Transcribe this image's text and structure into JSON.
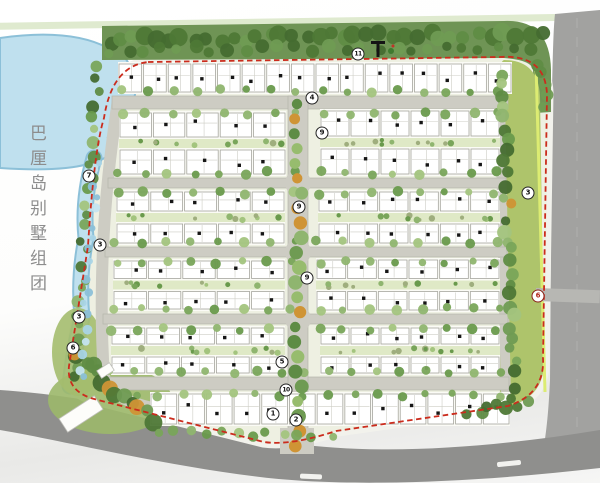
{
  "title": {
    "text": "巴厘岛别墅组团"
  },
  "colors": {
    "pale_strip": "#d9e6c7",
    "site_base": "#eef0e2",
    "water_fill": "#bfe0ee",
    "water_edge": "#8cc0d8",
    "tree_band": "#6f9455",
    "buffer_fill": "#aec46b",
    "buffer_line": "#dcec72",
    "road_fill": "#cdccc3",
    "road_edge": "#b6b5ac",
    "outer_road": "#a2a2a0",
    "bottom_road": "#8f8f8d",
    "boundary_red": "#cb2c1d",
    "house_fill": "#ffffff",
    "house_stroke": "#a6a69e",
    "house_inner": "#cdcdc5",
    "house_dot": "#161616",
    "garden": "#dfe9c6",
    "hedge": "#9fae7e",
    "tree_dark": [
      "#4e7836",
      "#5f8c44",
      "#446b30",
      "#6f9b53"
    ],
    "tree_street": [
      "#79a55a",
      "#8fb56f",
      "#699a4c",
      "#a3c47e"
    ],
    "tree_median": [
      "#6f9b53",
      "#8fb56f",
      "#5e8c45",
      "#97bc6e"
    ],
    "tree_orange": "#cf9435",
    "water_scallop": [
      "#a9d4e6",
      "#8cc0d8",
      "#c4e4f0"
    ],
    "white_dash": "#f2f2ef",
    "building_fill": "#fdfdfa",
    "gate_black": "#141414",
    "gate_green": "#3f7a2f",
    "gate_red": "#c23327",
    "title_color": "#8d8d8d"
  },
  "markers": [
    {
      "label": "7",
      "x": 89,
      "y": 176
    },
    {
      "label": "3",
      "x": 100,
      "y": 245
    },
    {
      "label": "3",
      "x": 79,
      "y": 317
    },
    {
      "label": "6",
      "x": 73,
      "y": 348
    },
    {
      "label": "11",
      "x": 358,
      "y": 54
    },
    {
      "label": "4",
      "x": 312,
      "y": 98
    },
    {
      "label": "9",
      "x": 322,
      "y": 133
    },
    {
      "label": "9",
      "x": 299,
      "y": 207
    },
    {
      "label": "9",
      "x": 307,
      "y": 278
    },
    {
      "label": "5",
      "x": 282,
      "y": 362
    },
    {
      "label": "10",
      "x": 286,
      "y": 390
    },
    {
      "label": "1",
      "x": 273,
      "y": 414
    },
    {
      "label": "2",
      "x": 296,
      "y": 420
    },
    {
      "label": "3",
      "x": 528,
      "y": 193
    },
    {
      "label": "6",
      "x": 538,
      "y": 296,
      "variant": "entrance"
    }
  ],
  "gate": {
    "x": 378,
    "y": 41
  },
  "site": {
    "paths": {
      "site_base": "M146,60 L500,54 Q549,50 551,92 L547,358 Q549,398 510,410 L338,434 Q292,449 263,445 L95,403 Q62,395 66,366 L86,246 Q92,148 102,116 Q110,63 146,60 Z",
      "boundary": "M148,62 L500,57 Q545,54 547,94 L543,358 Q545,394 508,406 L336,431 Q290,446 264,442 L98,400 Q66,393 69,366 L88,246 Q94,150 104,118 Q112,66 148,62 Z",
      "top_band": "M102,26 L504,21 Q550,19 551,70 L551,112 L535,113 L533,70 Q532,60 504,58 L102,60 Z",
      "buffer": "M504,60 Q538,60 540,96 L544,360 Q545,396 510,406 L500,407 L498,96 Q498,62 504,60 Z",
      "buffer_line": "M536,64 L545,392",
      "lake": "M0,38 Q70,28 108,48 Q138,58 126,82 Q146,92 122,112 Q142,126 108,138 Q122,156 88,164 Q60,172 0,168 Z",
      "water_strip": "M94,158 Q82,200 86,238 Q78,278 82,318 Q74,348 70,386",
      "bottom_road": "M0,390 C120,398 210,430 290,443 C380,456 490,448 600,430 L600,468 C480,482 350,488 260,477 C160,465 60,440 0,430 Z",
      "right_road": "M555,14 L600,10 L600,436 C580,438 560,442 544,446 C548,420 549,400 550,380 L552,90 C553,40 554,22 555,14 Z",
      "right_lane": "M577,18 L577,430",
      "left_road": "M118,100 Q106,180 103,248 Q100,318 104,376 Q108,398 152,408",
      "right_inner_road": "M500,100 L506,402"
    },
    "hroads": [
      {
        "x": 112,
        "y": 96,
        "w": 396,
        "h": 13
      },
      {
        "x": 108,
        "y": 178,
        "w": 398,
        "h": 10
      },
      {
        "x": 105,
        "y": 247,
        "w": 402,
        "h": 10
      },
      {
        "x": 103,
        "y": 314,
        "w": 405,
        "h": 10
      },
      {
        "x": 101,
        "y": 377,
        "w": 408,
        "h": 13
      }
    ],
    "spine": {
      "x": 288,
      "y": 96,
      "w": 20,
      "h": 352
    },
    "intersections": [
      [
        298,
        183
      ],
      [
        298,
        252
      ],
      [
        298,
        319
      ]
    ],
    "entrance_plaza": {
      "x": 280,
      "y": 428,
      "w": 34,
      "h": 26
    },
    "blocks": [
      {
        "x": 118,
        "y": 62,
        "w": 394,
        "h": 32,
        "rows": 1,
        "cols": 16
      },
      {
        "x": 119,
        "y": 111,
        "w": 167,
        "h": 65,
        "rows": 2,
        "cols": 5
      },
      {
        "x": 320,
        "y": 109,
        "w": 180,
        "h": 67,
        "rows": 2,
        "cols": 6
      },
      {
        "x": 116,
        "y": 190,
        "w": 169,
        "h": 55,
        "rows": 2,
        "cols": 5
      },
      {
        "x": 318,
        "y": 190,
        "w": 182,
        "h": 55,
        "rows": 2,
        "cols": 6
      },
      {
        "x": 113,
        "y": 259,
        "w": 172,
        "h": 52,
        "rows": 2,
        "cols": 5
      },
      {
        "x": 316,
        "y": 258,
        "w": 184,
        "h": 54,
        "rows": 2,
        "cols": 6
      },
      {
        "x": 111,
        "y": 326,
        "w": 174,
        "h": 49,
        "rows": 2,
        "cols": 5
      },
      {
        "x": 320,
        "y": 326,
        "w": 180,
        "h": 49,
        "rows": 2,
        "cols": 6
      },
      {
        "x": 150,
        "y": 392,
        "w": 360,
        "h": 34,
        "rows": 1,
        "cols": 13
      }
    ],
    "tree_lines": [
      {
        "x1": 108,
        "y1": 40,
        "x2": 540,
        "y2": 33,
        "n": 36,
        "rmin": 6,
        "rmax": 9.5,
        "palette": "dark"
      },
      {
        "x1": 112,
        "y1": 51,
        "x2": 530,
        "y2": 47,
        "n": 26,
        "rmin": 4.5,
        "rmax": 7,
        "palette": "dark"
      },
      {
        "x1": 541,
        "y1": 66,
        "x2": 546,
        "y2": 104,
        "n": 5,
        "rmin": 5,
        "rmax": 7,
        "palette": "dark"
      },
      {
        "x1": 503,
        "y1": 72,
        "x2": 514,
        "y2": 396,
        "n": 30,
        "rmin": 4.5,
        "rmax": 7.5,
        "palette": "mixed",
        "orange": 0.07
      },
      {
        "x1": 98,
        "y1": 68,
        "x2": 84,
        "y2": 240,
        "n": 15,
        "rmin": 4,
        "rmax": 6.5,
        "palette": "mixed"
      },
      {
        "x1": 84,
        "y1": 252,
        "x2": 74,
        "y2": 378,
        "n": 11,
        "rmin": 4,
        "rmax": 6.5,
        "palette": "mixed"
      },
      {
        "x1": 72,
        "y1": 352,
        "x2": 150,
        "y2": 420,
        "n": 13,
        "rmin": 5.5,
        "rmax": 9,
        "palette": "dark",
        "orange": 0.1
      },
      {
        "x1": 160,
        "y1": 429,
        "x2": 330,
        "y2": 437,
        "n": 12,
        "rmin": 3.5,
        "rmax": 5.5,
        "palette": "street"
      },
      {
        "x1": 470,
        "y1": 414,
        "x2": 528,
        "y2": 402,
        "n": 7,
        "rmin": 5,
        "rmax": 7.5,
        "palette": "dark"
      },
      {
        "x1": 96,
        "y1": 160,
        "x2": 80,
        "y2": 380,
        "n": 18,
        "rmin": 3,
        "rmax": 5,
        "palette": "water"
      }
    ],
    "median_line": {
      "x": 298,
      "y1": 104,
      "y2": 446,
      "n": 24,
      "rmin": 5,
      "rmax": 7.5,
      "orange": 0.18
    },
    "white_dashes": [
      {
        "x": 497,
        "y": 461,
        "w": 24,
        "h": 5,
        "rot": -6
      },
      {
        "x": 300,
        "y": 474,
        "w": 22,
        "h": 5,
        "rot": 2
      }
    ],
    "east_stub": {
      "x": 536,
      "y": 288,
      "w": 64,
      "h": 13
    },
    "buildings": [
      {
        "x": 60,
        "y": 406,
        "w": 42,
        "h": 16,
        "rot": -33
      },
      {
        "x": 98,
        "y": 366,
        "w": 15,
        "h": 9,
        "rot": -33
      }
    ]
  }
}
